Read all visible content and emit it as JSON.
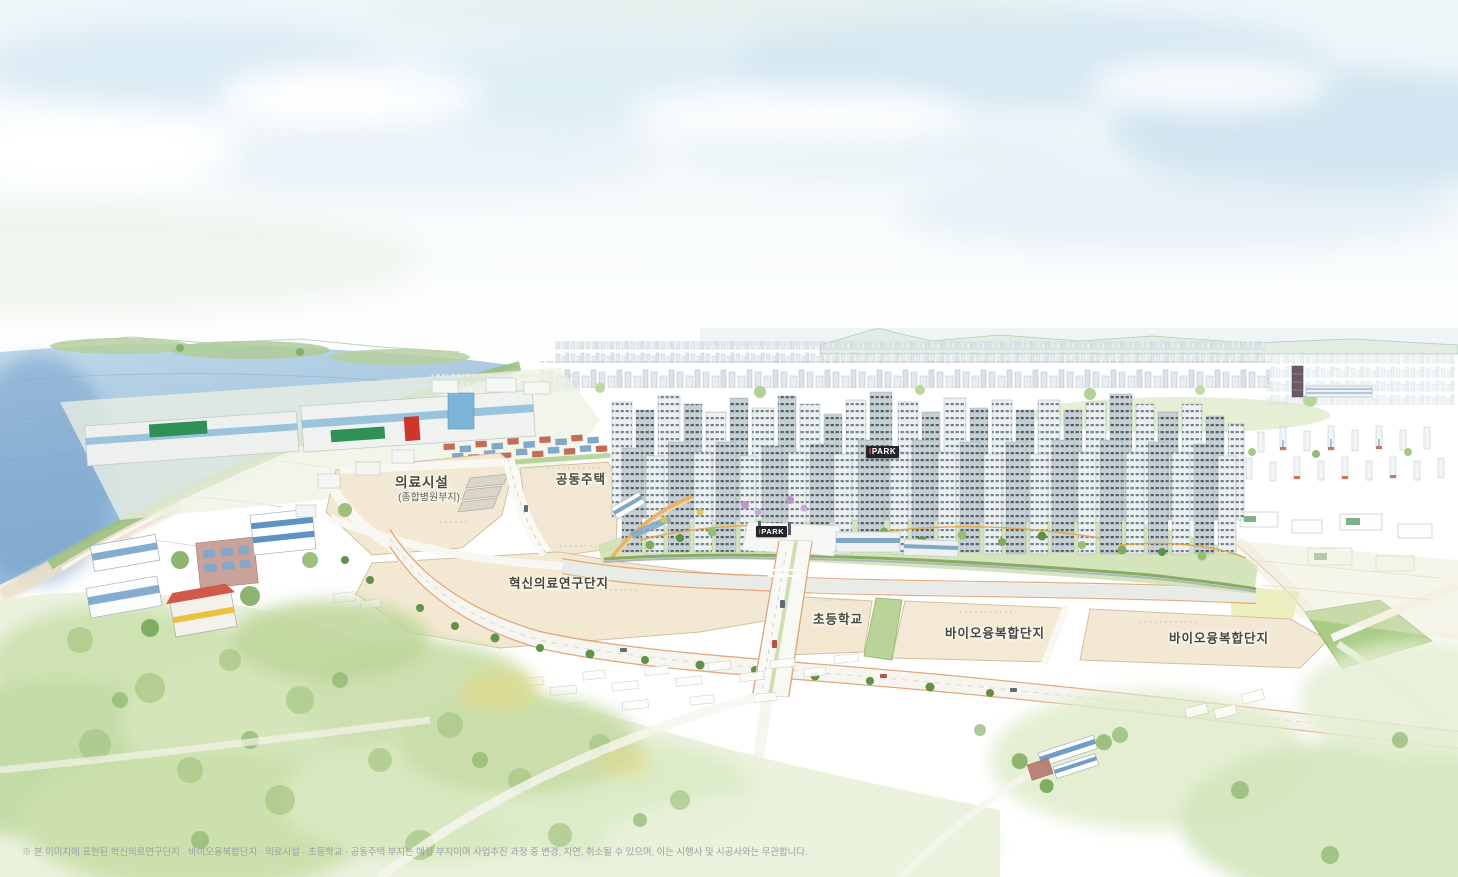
{
  "labels": {
    "medical_site": {
      "title": "의료시설",
      "subtitle": "(종합병원부지)"
    },
    "housing_site": {
      "title": "공동주택"
    },
    "research_site": {
      "title": "혁신의료연구단지"
    },
    "school_site": {
      "title": "초등학교"
    },
    "bio_site_1": {
      "title": "바이오융복합단지"
    },
    "bio_site_2": {
      "title": "바이오융복합단지"
    },
    "brand_sign_roof": {
      "prefix": "I",
      "rest": "PARK"
    },
    "brand_sign_gate": {
      "prefix": "I",
      "rest": "PARK"
    }
  },
  "footer": {
    "disclaimer": "※ 본 이미지에 표현된 혁신의료연구단지 · 바이오융복합단지 · 의료시설 · 초등학교 · 공동주택 부지는 예정 부지이며 사업추진 과정 중 변경, 지연, 취소될 수 있으며, 이는 시행사 및 시공사와는 무관합니다."
  },
  "colors": {
    "sky_wash": "#d7e8f2",
    "water": "#8fb6d8",
    "parcel_beige": "#f2e8d4",
    "greenery": "#b9d49a",
    "road_edge_accent": "#de9864",
    "brand_red": "#e8443a",
    "sign_background": "#22262a",
    "label_text": "#45483d",
    "disclaimer_text": "#9aa1a9"
  }
}
